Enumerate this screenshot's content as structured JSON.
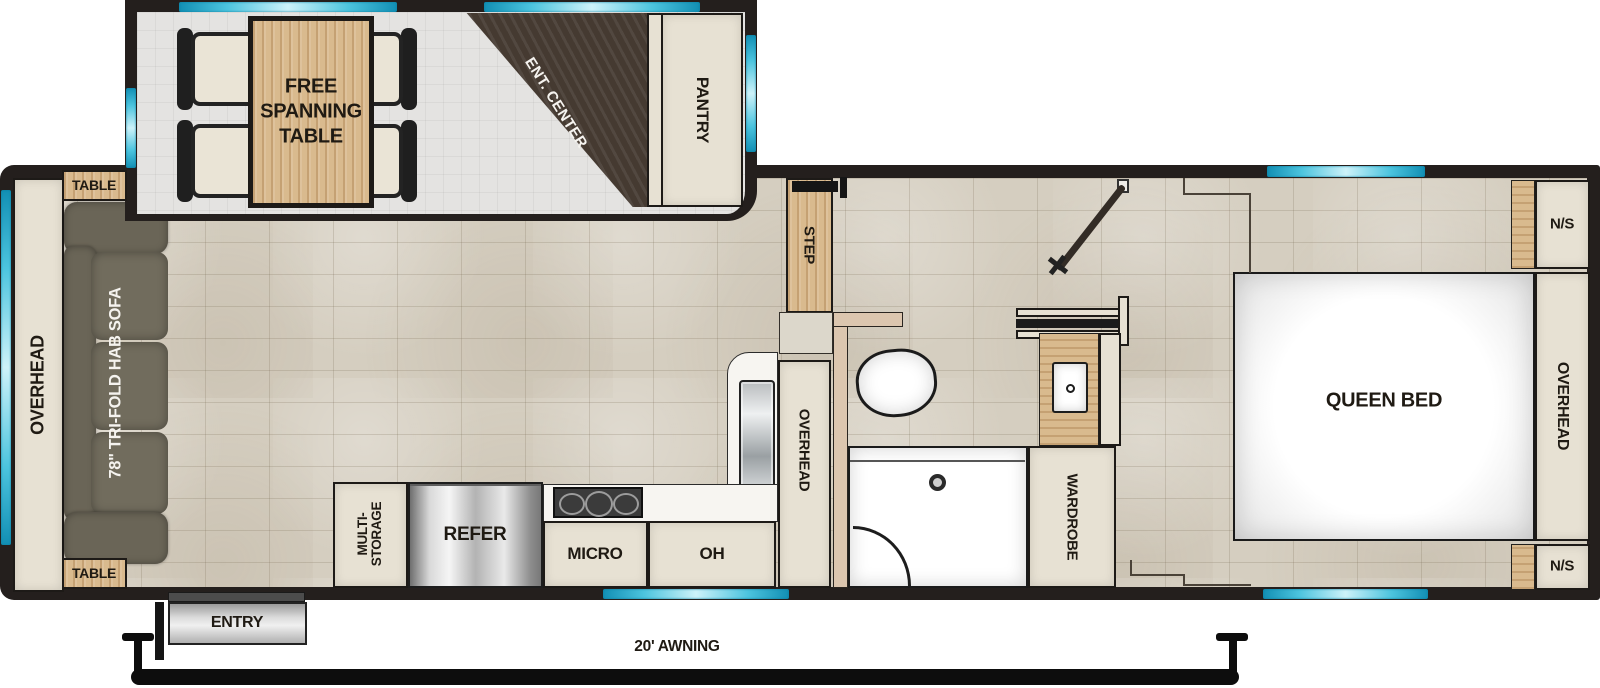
{
  "labels": {
    "slideout": {
      "free_spanning_table": "FREE SPANNING TABLE",
      "ent_center": "ENT. CENTER",
      "pantry": "PANTRY"
    },
    "living": {
      "overhead": "OVERHEAD",
      "table_top": "TABLE",
      "table_bottom": "TABLE",
      "sofa": "78\" TRI-FOLD HAB SOFA"
    },
    "kitchen": {
      "step": "STEP",
      "multi_storage": "MULTI-STORAGE",
      "refer": "REFER",
      "micro": "MICRO",
      "oh": "OH",
      "overhead": "OVERHEAD"
    },
    "bedroom": {
      "queen_bed": "QUEEN BED",
      "overhead": "OVERHEAD",
      "ns_top": "N/S",
      "ns_bottom": "N/S",
      "wardrobe": "WARDROBE"
    },
    "exterior": {
      "entry": "ENTRY",
      "awning": "20' AWNING"
    }
  },
  "colors": {
    "wall": "#241f1d",
    "floor_tile": "#d5cec0",
    "slide_floor": "#e4e3e1",
    "cabinet": "#e7e1d3",
    "wood": "#d9ba8e",
    "dark_wood": "#453a31",
    "sofa": "#6f6b5d",
    "window_cyan": "#2cb1d2",
    "fixture_white": "#ffffff"
  }
}
